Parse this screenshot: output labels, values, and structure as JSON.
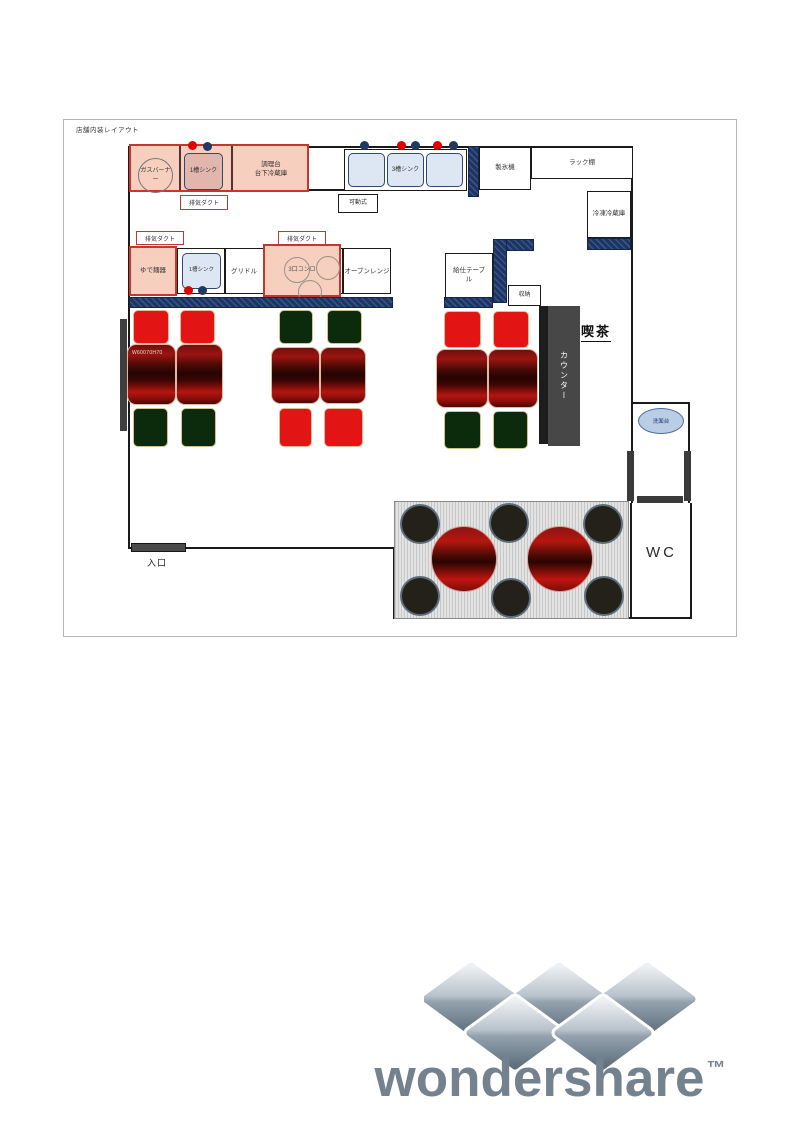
{
  "plan": {
    "title": "店舗内装レイアウト",
    "kitchen": {
      "gas_burner": "ガスバーナー",
      "sink_1": "1槽シンク",
      "prep_table_l1": "調理台",
      "prep_table_l2": "台下冷蔵庫",
      "exhaust_duct": "排気ダクト",
      "movable": "可動式",
      "sink_3": "3槽シンク",
      "ice_machine": "製氷機",
      "rack_shelf": "ラック棚",
      "freezer": "冷凍冷蔵庫",
      "noodle_boiler": "ゆで麺器",
      "griddle": "グリドル",
      "stove_3": "3口コンロ",
      "oven_range": "オーブンレンジ"
    },
    "hall": {
      "serving_table": "給仕テーブル",
      "storage": "収納",
      "counter": "カウンター",
      "cafe": "喫茶",
      "table_size": "W60070H70",
      "washstand": "洗面台",
      "wc": "WC",
      "entrance": "入口"
    }
  },
  "logo": {
    "brand": "wondershare",
    "tm": "™"
  },
  "colors": {
    "wall_navy": "#1f3864",
    "duct_pink": "#f7cfbe",
    "duct_border_red": "#c4372e",
    "sink_blue": "#dde7f4",
    "chair_red": "#e31414",
    "chair_green": "#0c2a0c",
    "table_maroon": "#6b0a08",
    "counter_gray": "#474747",
    "washstand_blue": "#b9cde5",
    "logo_gray": "#73828e"
  }
}
